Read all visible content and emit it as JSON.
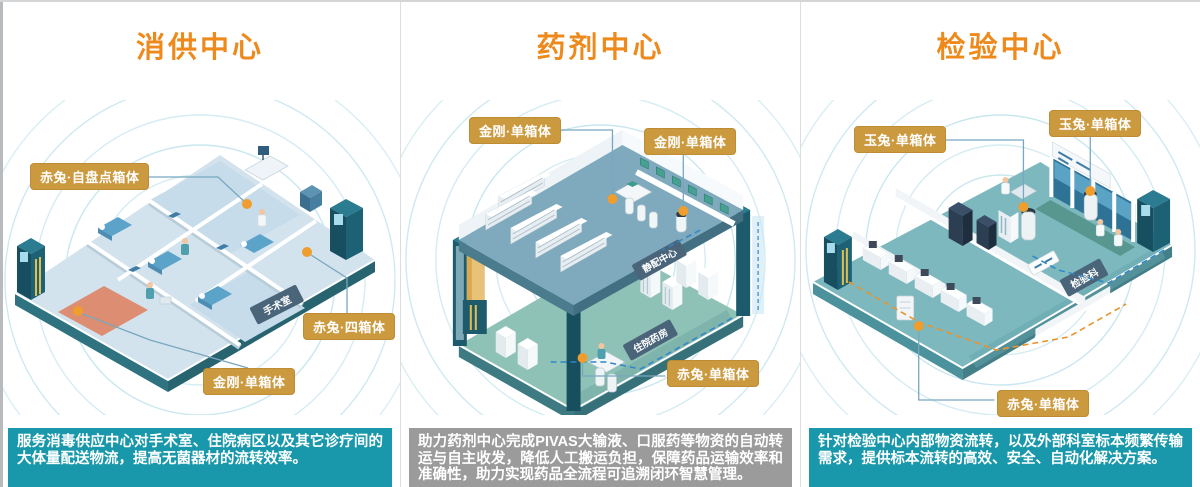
{
  "panels": [
    {
      "title": "消供中心",
      "labels": [
        {
          "text": "赤兔·自盘点箱体"
        },
        {
          "text": "赤兔·四箱体"
        },
        {
          "text": "金刚·单箱体"
        }
      ],
      "signs": {
        "room": "手术室"
      },
      "description": "服务消毒供应中心对手术室、住院病区以及其它诊疗间的大体量配送物流，提高无菌器材的流转效率。"
    },
    {
      "title": "药剂中心",
      "labels": [
        {
          "text": "金刚·单箱体"
        },
        {
          "text": "金刚·单箱体"
        },
        {
          "text": "赤兔·单箱体"
        }
      ],
      "signs": {
        "upper": "静配中心",
        "lower": "住院药房"
      },
      "description": "助力药剂中心完成PIVAS大输液、口服药等物资的自动转运与自主收发，降低人工搬运负担，保障药品运输效率和准确性，助力实现药品全流程可追溯闭环智慧管理。"
    },
    {
      "title": "检验中心",
      "labels": [
        {
          "text": "玉兔·单箱体"
        },
        {
          "text": "玉兔·单箱体"
        },
        {
          "text": "赤兔·单箱体"
        }
      ],
      "signs": {
        "room": "检验科"
      },
      "description": "针对检验中心内部物资流转，以及外部科室标本频繁传输需求，提供标本流转的高效、安全、自动化解决方案。"
    }
  ],
  "colors": {
    "title_orange": "#ee8a1c",
    "callout_bg": "#cb9a3f",
    "bar_teal": "#1898aa",
    "bar_gray": "#9b9b9b",
    "floor_blue": "#d3e3ee",
    "floor_teal": "#7cb8be",
    "upper_floor_blue": "#7fa9bd",
    "lower_floor_teal": "#8fc2b6",
    "dot_orange": "#ef9d2c",
    "sign_slate": "#4a6579"
  }
}
